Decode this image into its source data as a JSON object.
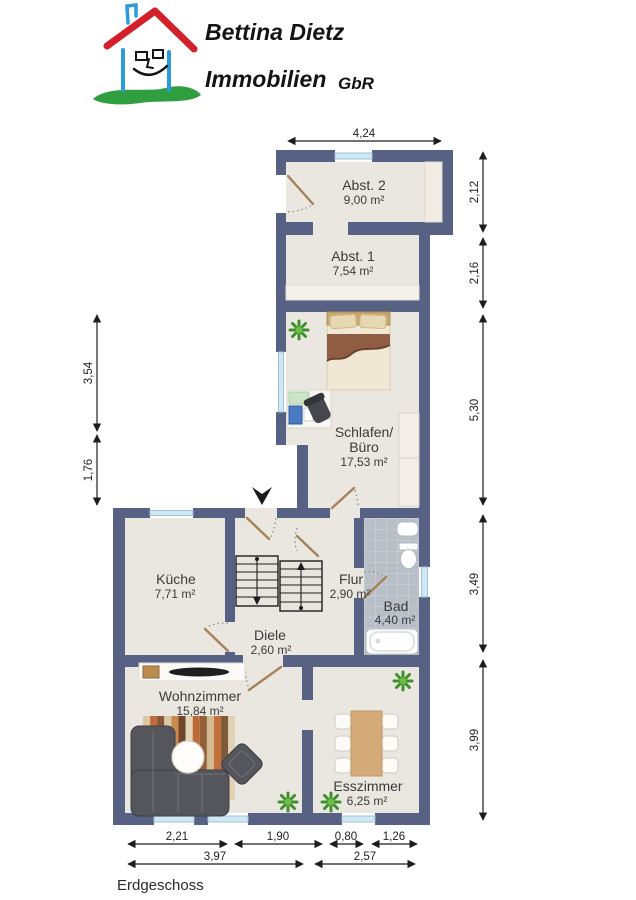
{
  "logo": {
    "line1": "Bettina Dietz",
    "line2": "Immobilien",
    "suffix": "GbR"
  },
  "plan": {
    "floor_label": "Erdgeschoss",
    "rooms": {
      "abst2": {
        "name": "Abst. 2",
        "area": "9,00 m²"
      },
      "abst1": {
        "name": "Abst. 1",
        "area": "7,54 m²"
      },
      "schlafen": {
        "name_line1": "Schlafen/",
        "name_line2": "Büro",
        "area": "17,53 m²"
      },
      "kueche": {
        "name": "Küche",
        "area": "7,71 m²"
      },
      "flur": {
        "name": "Flur",
        "area": "2,90 m²"
      },
      "bad": {
        "name": "Bad",
        "area": "4,40 m²"
      },
      "diele": {
        "name": "Diele",
        "area": "2,60 m²"
      },
      "wohnzimmer": {
        "name": "Wohnzimmer",
        "area": "15,84 m²"
      },
      "esszimmer": {
        "name": "Esszimmer",
        "area": "6,25 m²"
      }
    },
    "dimensions": {
      "top": "4,24",
      "right": [
        "2,12",
        "2,16",
        "5,30",
        "3,49",
        "3,99"
      ],
      "left": [
        "3,54",
        "1,76"
      ],
      "bottom_row1": [
        "2,21",
        "1,90",
        "0,80",
        "1,26"
      ],
      "bottom_row2": [
        "3,97",
        "2,57"
      ]
    }
  },
  "colors": {
    "wall": "#576183",
    "floor": "#eae7e0",
    "window_glass": "#cfe8f4",
    "bath_tile": "#b9bfc7",
    "roof_red": "#d3202a",
    "house_blue": "#2b9cd8",
    "grass_green": "#2f9e3f"
  }
}
